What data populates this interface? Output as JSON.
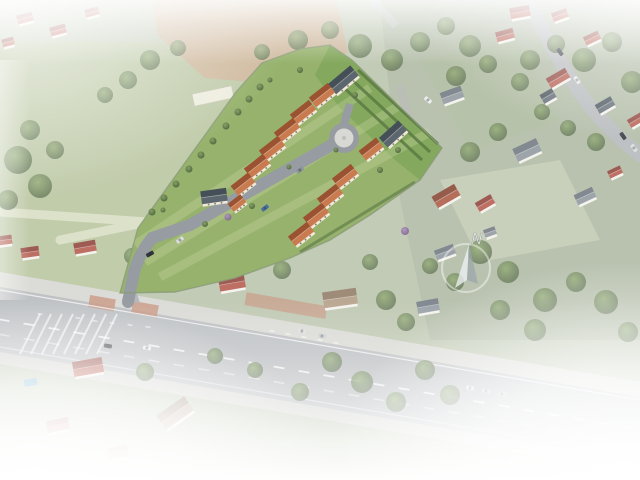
{
  "meta": {
    "description": "Oblique aerial photograph of a suburban neighborhood with a 3D architectural rendering of a new housing estate (cream houses, terracotta and slate roofs, cul-de-sac turnaround) inserted on a green parcel; wide avenue along the bottom; white haze fading at all edges",
    "compass_label": "N"
  },
  "compass": {
    "label": "N",
    "cx": 466,
    "cy": 268,
    "radius": 24
  },
  "palette": {
    "haze": "#ffffff",
    "meadow": "#b7c49e",
    "meadow_path": "#dde1c6",
    "field": "#c9af90",
    "photo_ground": "#b9c3ab",
    "garden_light": "#c6cdb6",
    "garden_mid": "#aab89a",
    "asphalt": "#b5b8bc",
    "sidewalk": "#d6d5d1",
    "terrace_red": "#c28a72",
    "dev_lawn": "#96b26c",
    "dev_garden": "#81a65a",
    "dev_stripe": "#cfdca8",
    "dev_road": "#969ca2",
    "round_inner": "#d8d8d4",
    "hedge": "#5a7a43",
    "fence": "#8a9b79",
    "wall_dev": "#f1ead8",
    "wall_photo": "#f3f1ec",
    "pool": "#5aa7c9",
    "marking": "#ffffff",
    "roofs": {
      "orange": [
        "#c97a4e",
        "#9a5231"
      ],
      "red": [
        "#b4584a",
        "#8f4038"
      ],
      "slate": [
        "#5c666f",
        "#454f58"
      ],
      "gray": [
        "#8d959c",
        "#6e767e"
      ],
      "tan": [
        "#b09a82",
        "#8f7a64"
      ],
      "bluegray": [
        "#7b8fa3",
        "#5f7285"
      ],
      "redbrown": [
        "#a8573f",
        "#84402e"
      ]
    }
  },
  "development": {
    "houses": [
      [
        343,
        80,
        30,
        13,
        -40,
        "slate"
      ],
      [
        322,
        95,
        24,
        12,
        -38,
        "orange"
      ],
      [
        303,
        112,
        24,
        12,
        -38,
        "orange"
      ],
      [
        287,
        130,
        24,
        12,
        -38,
        "orange"
      ],
      [
        272,
        148,
        24,
        12,
        -38,
        "orange"
      ],
      [
        257,
        166,
        24,
        12,
        -38,
        "orange"
      ],
      [
        243,
        184,
        22,
        12,
        -38,
        "orange"
      ],
      [
        214,
        196,
        26,
        13,
        -8,
        "slate"
      ],
      [
        237,
        203,
        16,
        10,
        -38,
        "orange"
      ],
      [
        393,
        134,
        26,
        13,
        -42,
        "slate"
      ],
      [
        371,
        149,
        22,
        12,
        -38,
        "orange"
      ],
      [
        345,
        176,
        24,
        12,
        -38,
        "orange"
      ],
      [
        330,
        196,
        24,
        12,
        -38,
        "orange"
      ],
      [
        316,
        215,
        24,
        12,
        -38,
        "orange"
      ],
      [
        301,
        234,
        24,
        12,
        -38,
        "orange"
      ]
    ],
    "trees": [
      [
        152,
        212,
        3.5
      ],
      [
        164,
        198,
        3.5
      ],
      [
        176,
        184,
        3.5
      ],
      [
        189,
        169,
        3.5
      ],
      [
        201,
        155,
        3.5
      ],
      [
        213,
        141,
        3.5
      ],
      [
        226,
        126,
        3.5
      ],
      [
        238,
        112,
        3.5
      ],
      [
        249,
        99,
        3.5
      ],
      [
        260,
        87,
        3.5
      ],
      [
        205,
        224,
        3
      ],
      [
        252,
        206,
        3
      ],
      [
        289,
        167,
        2.5
      ],
      [
        336,
        150,
        2.5
      ],
      [
        380,
        170,
        3
      ],
      [
        398,
        150,
        3
      ],
      [
        355,
        95,
        3
      ],
      [
        300,
        70,
        3
      ],
      [
        270,
        80,
        2.5
      ],
      [
        163,
        210,
        2.5
      ]
    ],
    "purple_trees": [
      [
        228,
        217,
        3.5
      ],
      [
        405,
        231,
        4
      ]
    ],
    "cars": [
      [
        265,
        208,
        -38,
        "#4a6fa5"
      ],
      [
        300,
        170,
        -38,
        "#8d959e"
      ],
      [
        180,
        240,
        -38,
        "#dcdcdc"
      ],
      [
        150,
        254,
        -30,
        "#33373c"
      ],
      [
        428,
        100,
        40,
        "#eceff0"
      ]
    ]
  },
  "existing": {
    "houses": [
      [
        452,
        95,
        22,
        12,
        -20,
        "gray"
      ],
      [
        505,
        35,
        18,
        10,
        -15,
        "red"
      ],
      [
        520,
        12,
        20,
        11,
        -10,
        "red"
      ],
      [
        560,
        15,
        16,
        9,
        -20,
        "red"
      ],
      [
        592,
        38,
        16,
        9,
        -25,
        "red"
      ],
      [
        558,
        78,
        22,
        11,
        -30,
        "red"
      ],
      [
        548,
        96,
        14,
        10,
        -30,
        "slate"
      ],
      [
        605,
        105,
        18,
        10,
        -30,
        "slate"
      ],
      [
        636,
        120,
        16,
        9,
        -30,
        "red"
      ],
      [
        527,
        150,
        26,
        14,
        -25,
        "gray"
      ],
      [
        615,
        172,
        14,
        8,
        -25,
        "red"
      ],
      [
        585,
        196,
        20,
        11,
        -25,
        "gray"
      ],
      [
        446,
        196,
        26,
        13,
        -30,
        "redbrown"
      ],
      [
        485,
        203,
        18,
        10,
        -30,
        "red"
      ],
      [
        445,
        252,
        20,
        10,
        -20,
        "gray"
      ],
      [
        490,
        232,
        12,
        8,
        -20,
        "gray"
      ],
      [
        5,
        240,
        14,
        9,
        -8,
        "red"
      ],
      [
        30,
        252,
        18,
        10,
        -8,
        "red"
      ],
      [
        85,
        247,
        22,
        11,
        -10,
        "red"
      ],
      [
        168,
        276,
        24,
        13,
        -10,
        "bluegray"
      ],
      [
        232,
        283,
        26,
        13,
        -10,
        "red"
      ],
      [
        340,
        298,
        34,
        16,
        -8,
        "tan"
      ],
      [
        428,
        306,
        22,
        12,
        -10,
        "gray"
      ],
      [
        88,
        367,
        30,
        15,
        -10,
        "red"
      ],
      [
        58,
        425,
        22,
        12,
        -12,
        "red"
      ],
      [
        175,
        413,
        34,
        17,
        -35,
        "tan"
      ],
      [
        118,
        452,
        20,
        11,
        -10,
        "red"
      ],
      [
        25,
        18,
        16,
        9,
        -15,
        "red"
      ],
      [
        58,
        30,
        16,
        9,
        -15,
        "red"
      ],
      [
        92,
        12,
        14,
        8,
        -15,
        "red"
      ],
      [
        8,
        42,
        12,
        8,
        -15,
        "red"
      ]
    ],
    "trees": [
      [
        18,
        160,
        14
      ],
      [
        40,
        186,
        12
      ],
      [
        8,
        200,
        10
      ],
      [
        55,
        150,
        9
      ],
      [
        30,
        130,
        10
      ],
      [
        150,
        60,
        10
      ],
      [
        178,
        48,
        8
      ],
      [
        128,
        80,
        9
      ],
      [
        105,
        95,
        8
      ],
      [
        262,
        52,
        8
      ],
      [
        298,
        40,
        10
      ],
      [
        330,
        30,
        9
      ],
      [
        360,
        46,
        12
      ],
      [
        392,
        60,
        11
      ],
      [
        420,
        42,
        10
      ],
      [
        446,
        26,
        9
      ],
      [
        470,
        46,
        11
      ],
      [
        456,
        76,
        10
      ],
      [
        488,
        64,
        9
      ],
      [
        520,
        82,
        9
      ],
      [
        542,
        112,
        8
      ],
      [
        568,
        128,
        8
      ],
      [
        596,
        142,
        9
      ],
      [
        612,
        42,
        10
      ],
      [
        632,
        82,
        11
      ],
      [
        584,
        60,
        12
      ],
      [
        556,
        44,
        9
      ],
      [
        530,
        60,
        10
      ],
      [
        470,
        152,
        10
      ],
      [
        498,
        132,
        9
      ],
      [
        430,
        266,
        8
      ],
      [
        455,
        282,
        9
      ],
      [
        480,
        252,
        12
      ],
      [
        508,
        272,
        11
      ],
      [
        545,
        300,
        12
      ],
      [
        576,
        282,
        10
      ],
      [
        606,
        302,
        12
      ],
      [
        628,
        332,
        10
      ],
      [
        500,
        310,
        10
      ],
      [
        535,
        330,
        11
      ],
      [
        132,
        256,
        8
      ],
      [
        282,
        270,
        9
      ],
      [
        386,
        300,
        10
      ],
      [
        406,
        322,
        9
      ],
      [
        370,
        262,
        8
      ],
      [
        145,
        372,
        9
      ],
      [
        215,
        356,
        8
      ],
      [
        332,
        362,
        10
      ],
      [
        362,
        382,
        11
      ],
      [
        396,
        402,
        10
      ],
      [
        300,
        392,
        9
      ],
      [
        255,
        370,
        8
      ],
      [
        425,
        370,
        10
      ],
      [
        450,
        395,
        10
      ]
    ],
    "cars": [
      [
        108,
        346,
        10,
        "#3a3f45"
      ],
      [
        147,
        348,
        10,
        "#ececec"
      ],
      [
        302,
        331,
        10,
        "#dcdcdc"
      ],
      [
        322,
        336,
        10,
        "#c6cacd"
      ],
      [
        470,
        388,
        10,
        "#e8e8e8"
      ],
      [
        486,
        391,
        10,
        "#d7d7d7"
      ],
      [
        502,
        394,
        10,
        "#c9c9c9"
      ],
      [
        560,
        52,
        55,
        "#30343a"
      ],
      [
        577,
        80,
        55,
        "#e8e8e8"
      ],
      [
        623,
        136,
        55,
        "#2f3338"
      ],
      [
        634,
        148,
        55,
        "#dddddd"
      ]
    ]
  },
  "main_road": {
    "dash_count": 26,
    "dash_spacing": 25,
    "angle_deg": 9.8,
    "glyph_marks": [
      [
        40,
        314
      ],
      [
        78,
        318
      ],
      [
        95,
        321
      ],
      [
        112,
        323
      ],
      [
        130,
        325
      ],
      [
        148,
        327
      ],
      [
        272,
        331
      ],
      [
        288,
        334
      ],
      [
        304,
        337
      ],
      [
        320,
        340
      ],
      [
        336,
        343
      ]
    ],
    "hatch_count": 8
  }
}
